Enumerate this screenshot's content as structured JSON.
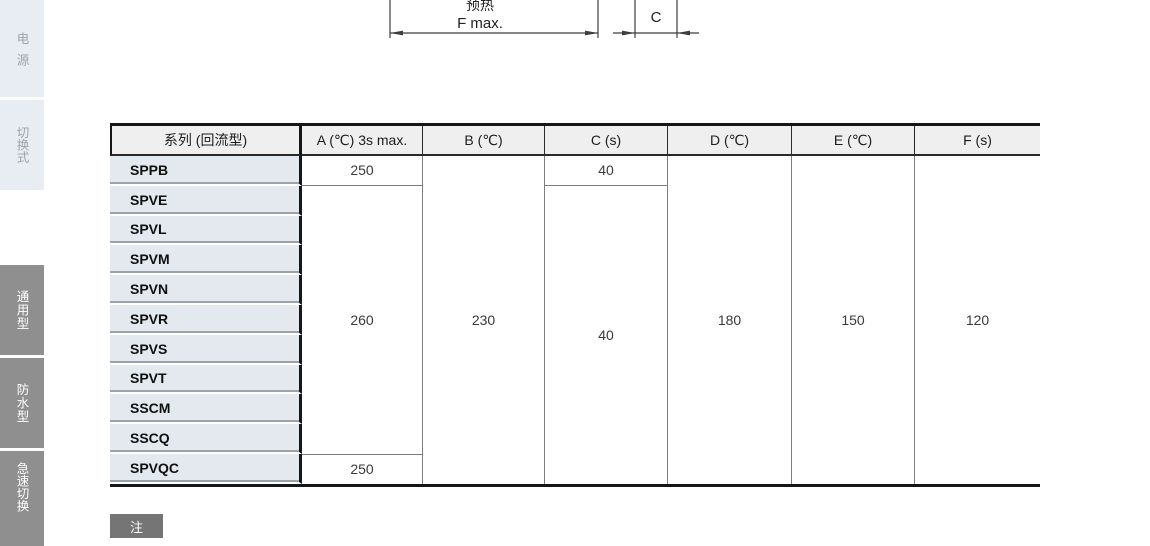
{
  "sidebar": {
    "tabs": [
      {
        "label": "电源",
        "style": "light"
      },
      {
        "label": "切换式",
        "style": "light"
      },
      {
        "label": "通用型",
        "style": "dark"
      },
      {
        "label": "防水型",
        "style": "dark"
      },
      {
        "label": "急速切换",
        "style": "dark"
      }
    ]
  },
  "diagram": {
    "labels": {
      "preheat": "预热",
      "f_max": "F max.",
      "c": "C"
    }
  },
  "table": {
    "headers": [
      "系列 (回流型)",
      "A (℃) 3s max.",
      "B (℃)",
      "C (s)",
      "D (℃)",
      "E (℃)",
      "F (s)"
    ],
    "series": [
      "SPPB",
      "SPVE",
      "SPVL",
      "SPVM",
      "SPVN",
      "SPVR",
      "SPVS",
      "SPVT",
      "SSCM",
      "SSCQ",
      "SPVQC"
    ],
    "cells": {
      "a_sppb": "250",
      "a_spve_to_sscq": "260",
      "a_spvqc": "250",
      "b_all": "230",
      "c_sppb": "40",
      "c_spve_to_spvqc": "40",
      "d_all": "180",
      "e_all": "150",
      "f_all": "120"
    }
  },
  "note": {
    "label": "注"
  },
  "colors": {
    "tab_light_bg": "#e7edf3",
    "tab_light_text": "#99a3ac",
    "tab_dark_bg": "#8f8f8f",
    "series_cell_bg": "#e3e9ef",
    "header_bg": "#efefef",
    "grid_line": "#7d7d7d",
    "heavy_line": "#161616",
    "note_bg": "#757575"
  }
}
